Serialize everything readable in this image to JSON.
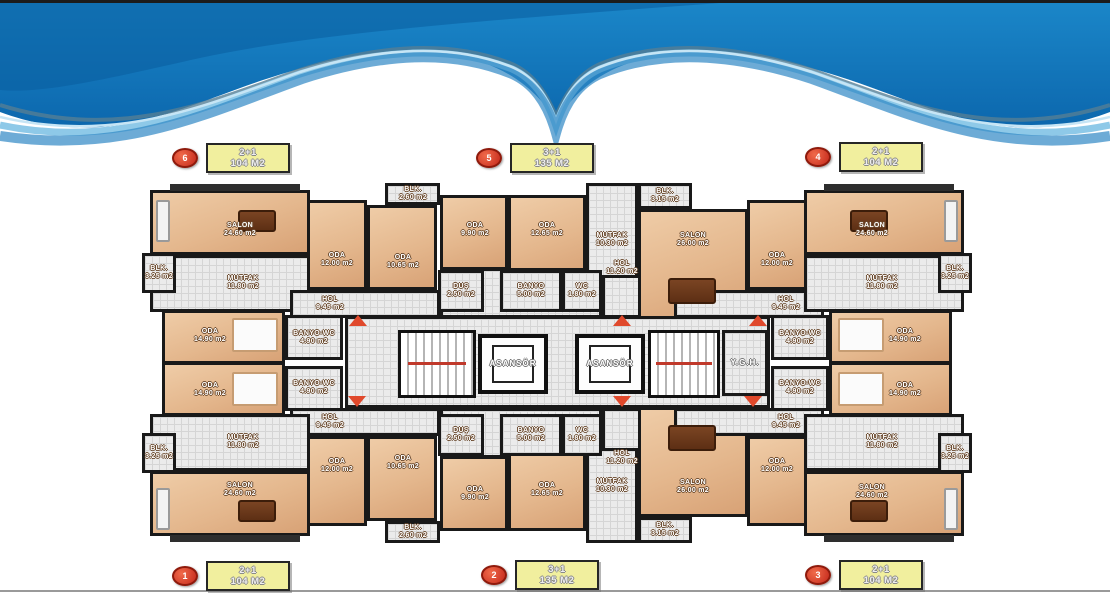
{
  "units": [
    {
      "number": "6",
      "type": "2+1",
      "size": "104 M2"
    },
    {
      "number": "5",
      "type": "3+1",
      "size": "135 M2"
    },
    {
      "number": "4",
      "type": "2+1",
      "size": "104 M2"
    },
    {
      "number": "1",
      "type": "2+1",
      "size": "104 M2"
    },
    {
      "number": "2",
      "type": "3+1",
      "size": "135 M2"
    },
    {
      "number": "3",
      "type": "2+1",
      "size": "104 M2"
    }
  ],
  "rooms": [
    {
      "name": "SALON",
      "area": "24.60 m2"
    },
    {
      "name": "MUTFAK",
      "area": "11.80 m2"
    },
    {
      "name": "BLK.",
      "area": "3.25 m2"
    },
    {
      "name": "ODA",
      "area": "12.00 m2"
    },
    {
      "name": "BLK.",
      "area": "2.60 m2"
    },
    {
      "name": "ODA",
      "area": "10.65 m2"
    },
    {
      "name": "HOL",
      "area": "9.45 m2"
    },
    {
      "name": "ODA",
      "area": "14.90 m2"
    },
    {
      "name": "BANYO-WC",
      "area": "4.90 m2"
    },
    {
      "name": "DUŞ",
      "area": "2.50 m2"
    },
    {
      "name": "ODA",
      "area": "9.90 m2"
    },
    {
      "name": "ODA",
      "area": "12.65 m2"
    },
    {
      "name": "MUTFAK",
      "area": "10.30 m2"
    },
    {
      "name": "BLK.",
      "area": "3.15 m2"
    },
    {
      "name": "SALON",
      "area": "26.00 m2"
    },
    {
      "name": "HOL",
      "area": "11.20 m2"
    },
    {
      "name": "BANYO",
      "area": "5.00 m2"
    },
    {
      "name": "WC",
      "area": "1.80 m2"
    },
    {
      "name": "ODA",
      "area": "12.00 m2"
    },
    {
      "name": "HOL",
      "area": "9.45 m2"
    },
    {
      "name": "BANYO-WC",
      "area": "4.90 m2"
    },
    {
      "name": "ODA",
      "area": "14.90 m2"
    },
    {
      "name": "SALON",
      "area": "24.60 m2"
    },
    {
      "name": "MUTFAK",
      "area": "11.80 m2"
    },
    {
      "name": "BLK.",
      "area": "3.25 m2"
    },
    {
      "name": "ASANSÖR"
    },
    {
      "name": "ASANSÖR"
    },
    {
      "name": "Y.G.H."
    },
    {
      "name": "ODA",
      "area": "14.90 m2"
    },
    {
      "name": "BANYO-WC",
      "area": "4.90 m2"
    },
    {
      "name": "HOL",
      "area": "9.45 m2"
    },
    {
      "name": "MUTFAK",
      "area": "11.80 m2"
    },
    {
      "name": "BLK.",
      "area": "3.25 m2"
    },
    {
      "name": "SALON",
      "area": "24.60 m2"
    },
    {
      "name": "ODA",
      "area": "12.00 m2"
    },
    {
      "name": "ODA",
      "area": "10.65 m2"
    },
    {
      "name": "BLK.",
      "area": "2.60 m2"
    },
    {
      "name": "DUŞ",
      "area": "2.50 m2"
    },
    {
      "name": "BANYO",
      "area": "5.00 m2"
    },
    {
      "name": "WC",
      "area": "1.80 m2"
    },
    {
      "name": "HOL",
      "area": "11.20 m2"
    },
    {
      "name": "ODA",
      "area": "9.90 m2"
    },
    {
      "name": "ODA",
      "area": "12.65 m2"
    },
    {
      "name": "MUTFAK",
      "area": "10.30 m2"
    },
    {
      "name": "SALON",
      "area": "26.00 m2"
    },
    {
      "name": "BLK.",
      "area": "3.15 m2"
    },
    {
      "name": "ODA",
      "area": "14.90 m2"
    },
    {
      "name": "BANYO-WC",
      "area": "4.90 m2"
    },
    {
      "name": "HOL",
      "area": "9.45 m2"
    },
    {
      "name": "ODA",
      "area": "12.00 m2"
    },
    {
      "name": "MUTFAK",
      "area": "11.80 m2"
    },
    {
      "name": "BLK.",
      "area": "3.25 m2"
    },
    {
      "name": "SALON",
      "area": "24.60 m2"
    }
  ],
  "colors": {
    "banner_blue": "#1076ba",
    "banner_light": "#8ec9e8",
    "wall": "#191919",
    "floor_wood": "#e3b68c",
    "tile": "#ebebeb",
    "badge_red": "#c3271a",
    "tag_yellow": "#f1ef9e",
    "arrow_red": "#e0492c"
  }
}
